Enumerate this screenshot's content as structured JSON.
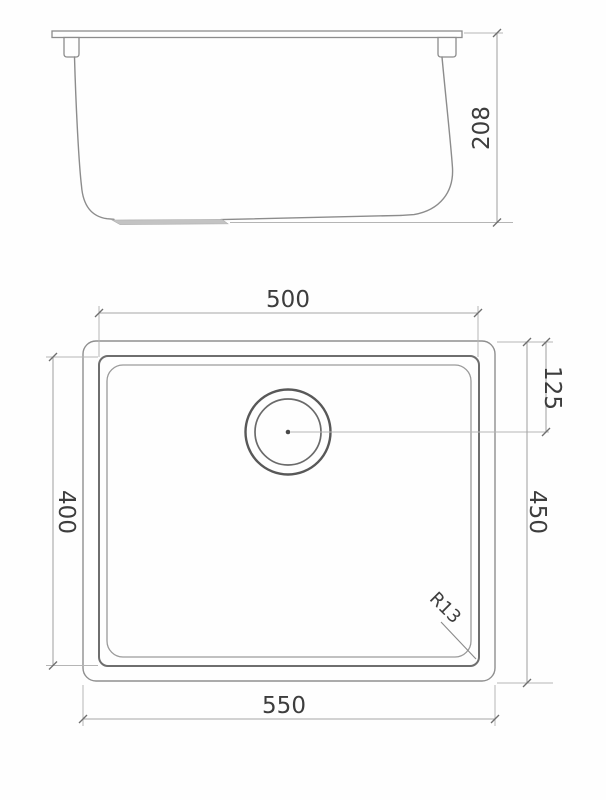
{
  "colors": {
    "background": "#ffffff",
    "drawing_line": "#8c8c8c",
    "bowl_edge_line": "#6e6e6e",
    "dimension_line": "#a6a6a6",
    "extension_line": "#b5b5b5",
    "text": "#3d3d3d",
    "drain_pad_fill": "#c3c3c3"
  },
  "side_view": {
    "height_label": "208"
  },
  "plan_view": {
    "bowl_width_label": "500",
    "drain_offset_label": "125",
    "bowl_depth_label": "400",
    "overall_depth_label": "450",
    "corner_radius_label": "R13",
    "overall_width_label": "550"
  }
}
